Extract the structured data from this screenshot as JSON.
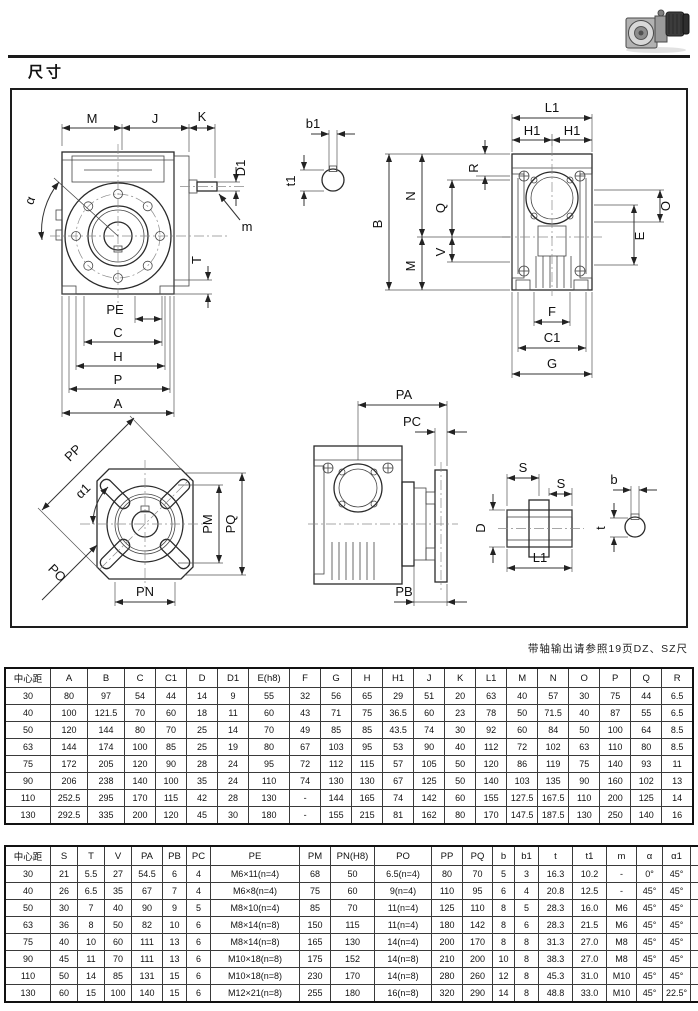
{
  "page": {
    "title": "尺寸",
    "note": "带轴输出请参照19页DZ、SZ尺"
  },
  "drawing": {
    "labels": {
      "M": "M",
      "J": "J",
      "K": "K",
      "D1": "D1",
      "m": "m",
      "alpha": "α",
      "T": "T",
      "PE": "PE",
      "C": "C",
      "H": "H",
      "P": "P",
      "A": "A",
      "b1": "b1",
      "t1": "t1",
      "L1": "L1",
      "H1": "H1",
      "B": "B",
      "N": "N",
      "Q": "Q",
      "V": "V",
      "R": "R",
      "O": "O",
      "E": "E",
      "F": "F",
      "C1": "C1",
      "G": "G",
      "PP": "PP",
      "alpha1": "α1",
      "PO": "PO",
      "PM": "PM",
      "PQ": "PQ",
      "PN": "PN",
      "PA": "PA",
      "PC": "PC",
      "PB": "PB",
      "S": "S",
      "D": "D",
      "b": "b",
      "t": "t"
    }
  },
  "tables": {
    "dims1": {
      "headers": [
        "中心距",
        "A",
        "B",
        "C",
        "C1",
        "D",
        "D1",
        "E(h8)",
        "F",
        "G",
        "H",
        "H1",
        "J",
        "K",
        "L1",
        "M",
        "N",
        "O",
        "P",
        "Q",
        "R"
      ],
      "rows": [
        [
          "30",
          "80",
          "97",
          "54",
          "44",
          "14",
          "9",
          "55",
          "32",
          "56",
          "65",
          "29",
          "51",
          "20",
          "63",
          "40",
          "57",
          "30",
          "75",
          "44",
          "6.5"
        ],
        [
          "40",
          "100",
          "121.5",
          "70",
          "60",
          "18",
          "11",
          "60",
          "43",
          "71",
          "75",
          "36.5",
          "60",
          "23",
          "78",
          "50",
          "71.5",
          "40",
          "87",
          "55",
          "6.5"
        ],
        [
          "50",
          "120",
          "144",
          "80",
          "70",
          "25",
          "14",
          "70",
          "49",
          "85",
          "85",
          "43.5",
          "74",
          "30",
          "92",
          "60",
          "84",
          "50",
          "100",
          "64",
          "8.5"
        ],
        [
          "63",
          "144",
          "174",
          "100",
          "85",
          "25",
          "19",
          "80",
          "67",
          "103",
          "95",
          "53",
          "90",
          "40",
          "112",
          "72",
          "102",
          "63",
          "110",
          "80",
          "8.5"
        ],
        [
          "75",
          "172",
          "205",
          "120",
          "90",
          "28",
          "24",
          "95",
          "72",
          "112",
          "115",
          "57",
          "105",
          "50",
          "120",
          "86",
          "119",
          "75",
          "140",
          "93",
          "11"
        ],
        [
          "90",
          "206",
          "238",
          "140",
          "100",
          "35",
          "24",
          "110",
          "74",
          "130",
          "130",
          "67",
          "125",
          "50",
          "140",
          "103",
          "135",
          "90",
          "160",
          "102",
          "13"
        ],
        [
          "110",
          "252.5",
          "295",
          "170",
          "115",
          "42",
          "28",
          "130",
          "-",
          "144",
          "165",
          "74",
          "142",
          "60",
          "155",
          "127.5",
          "167.5",
          "110",
          "200",
          "125",
          "14"
        ],
        [
          "130",
          "292.5",
          "335",
          "200",
          "120",
          "45",
          "30",
          "180",
          "-",
          "155",
          "215",
          "81",
          "162",
          "80",
          "170",
          "147.5",
          "187.5",
          "130",
          "250",
          "140",
          "16"
        ]
      ]
    },
    "dims2": {
      "headers": [
        "中心距",
        "S",
        "T",
        "V",
        "PA",
        "PB",
        "PC",
        "PE",
        "PM",
        "PN(H8)",
        "PO",
        "PP",
        "PQ",
        "b",
        "b1",
        "t",
        "t1",
        "m",
        "α",
        "α1",
        "Kg"
      ],
      "rows": [
        [
          "30",
          "21",
          "5.5",
          "27",
          "54.5",
          "6",
          "4",
          "M6×11(n=4)",
          "68",
          "50",
          "6.5(n=4)",
          "80",
          "70",
          "5",
          "3",
          "16.3",
          "10.2",
          "-",
          "0°",
          "45°",
          "1.2"
        ],
        [
          "40",
          "26",
          "6.5",
          "35",
          "67",
          "7",
          "4",
          "M6×8(n=4)",
          "75",
          "60",
          "9(n=4)",
          "110",
          "95",
          "6",
          "4",
          "20.8",
          "12.5",
          "-",
          "45°",
          "45°",
          "2.3"
        ],
        [
          "50",
          "30",
          "7",
          "40",
          "90",
          "9",
          "5",
          "M8×10(n=4)",
          "85",
          "70",
          "11(n=4)",
          "125",
          "110",
          "8",
          "5",
          "28.3",
          "16.0",
          "M6",
          "45°",
          "45°",
          "3.5"
        ],
        [
          "63",
          "36",
          "8",
          "50",
          "82",
          "10",
          "6",
          "M8×14(n=8)",
          "150",
          "115",
          "11(n=4)",
          "180",
          "142",
          "8",
          "6",
          "28.3",
          "21.5",
          "M6",
          "45°",
          "45°",
          "6.2"
        ],
        [
          "75",
          "40",
          "10",
          "60",
          "111",
          "13",
          "6",
          "M8×14(n=8)",
          "165",
          "130",
          "14(n=4)",
          "200",
          "170",
          "8",
          "8",
          "31.3",
          "27.0",
          "M8",
          "45°",
          "45°",
          "9"
        ],
        [
          "90",
          "45",
          "11",
          "70",
          "111",
          "13",
          "6",
          "M10×18(n=8)",
          "175",
          "152",
          "14(n=8)",
          "210",
          "200",
          "10",
          "8",
          "38.3",
          "27.0",
          "M8",
          "45°",
          "45°",
          "13"
        ],
        [
          "110",
          "50",
          "14",
          "85",
          "131",
          "15",
          "6",
          "M10×18(n=8)",
          "230",
          "170",
          "14(n=8)",
          "280",
          "260",
          "12",
          "8",
          "45.3",
          "31.0",
          "M10",
          "45°",
          "45°",
          "35"
        ],
        [
          "130",
          "60",
          "15",
          "100",
          "140",
          "15",
          "6",
          "M12×21(n=8)",
          "255",
          "180",
          "16(n=8)",
          "320",
          "290",
          "14",
          "8",
          "48.8",
          "33.0",
          "M10",
          "45°",
          "22.5°",
          "48"
        ]
      ]
    }
  }
}
